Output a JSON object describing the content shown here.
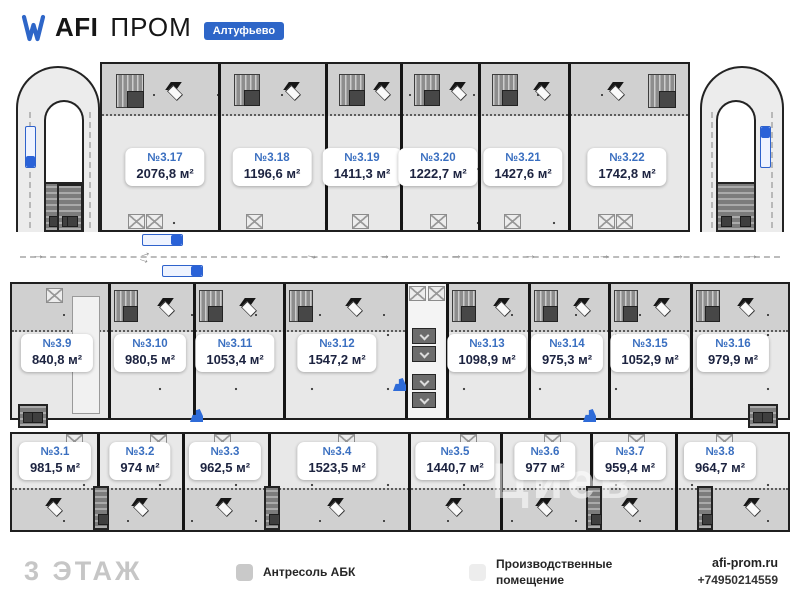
{
  "header": {
    "brand_bold": "AFI",
    "brand_regular": "ПРОМ",
    "location_badge": "Алтуфьево"
  },
  "plan": {
    "floor_label": "3 ЭТАЖ",
    "watermark": "Циев",
    "units": {
      "top": [
        {
          "no": "№3.17",
          "area": "2076,8 м²"
        },
        {
          "no": "№3.18",
          "area": "1196,6 м²"
        },
        {
          "no": "№3.19",
          "area": "1411,3 м²"
        },
        {
          "no": "№3.20",
          "area": "1222,7 м²"
        },
        {
          "no": "№3.21",
          "area": "1427,6 м²"
        },
        {
          "no": "№3.22",
          "area": "1742,8 м²"
        }
      ],
      "middle": [
        {
          "no": "№3.9",
          "area": "840,8 м²"
        },
        {
          "no": "№3.10",
          "area": "980,5 м²"
        },
        {
          "no": "№3.11",
          "area": "1053,4 м²"
        },
        {
          "no": "№3.12",
          "area": "1547,2 м²"
        },
        {
          "no": "№3.13",
          "area": "1098,9 м²"
        },
        {
          "no": "№3.14",
          "area": "975,3 м²"
        },
        {
          "no": "№3.15",
          "area": "1052,9 м²"
        },
        {
          "no": "№3.16",
          "area": "979,9 м²"
        }
      ],
      "bottom": [
        {
          "no": "№3.1",
          "area": "981,5 м²"
        },
        {
          "no": "№3.2",
          "area": "974 м²"
        },
        {
          "no": "№3.3",
          "area": "962,5 м²"
        },
        {
          "no": "№3.4",
          "area": "1523,5 м²"
        },
        {
          "no": "№3.5",
          "area": "1440,7 м²"
        },
        {
          "no": "№3.6",
          "area": "977 м²"
        },
        {
          "no": "№3.7",
          "area": "959,4 м²"
        },
        {
          "no": "№3.8",
          "area": "964,7 м²"
        }
      ]
    }
  },
  "legend": {
    "items": [
      {
        "label": "Антресоль АБК",
        "color": "#c9c9c9"
      },
      {
        "label": "Производственные помещение",
        "color": "#ededed"
      }
    ]
  },
  "footer": {
    "website": "afi-prom.ru",
    "phone": "+74950214559"
  },
  "colors": {
    "accent_blue": "#2e66c8",
    "antresol_gray": "#c9c9c9",
    "production_gray": "#ededed",
    "wall_black": "#1f1f1f"
  }
}
